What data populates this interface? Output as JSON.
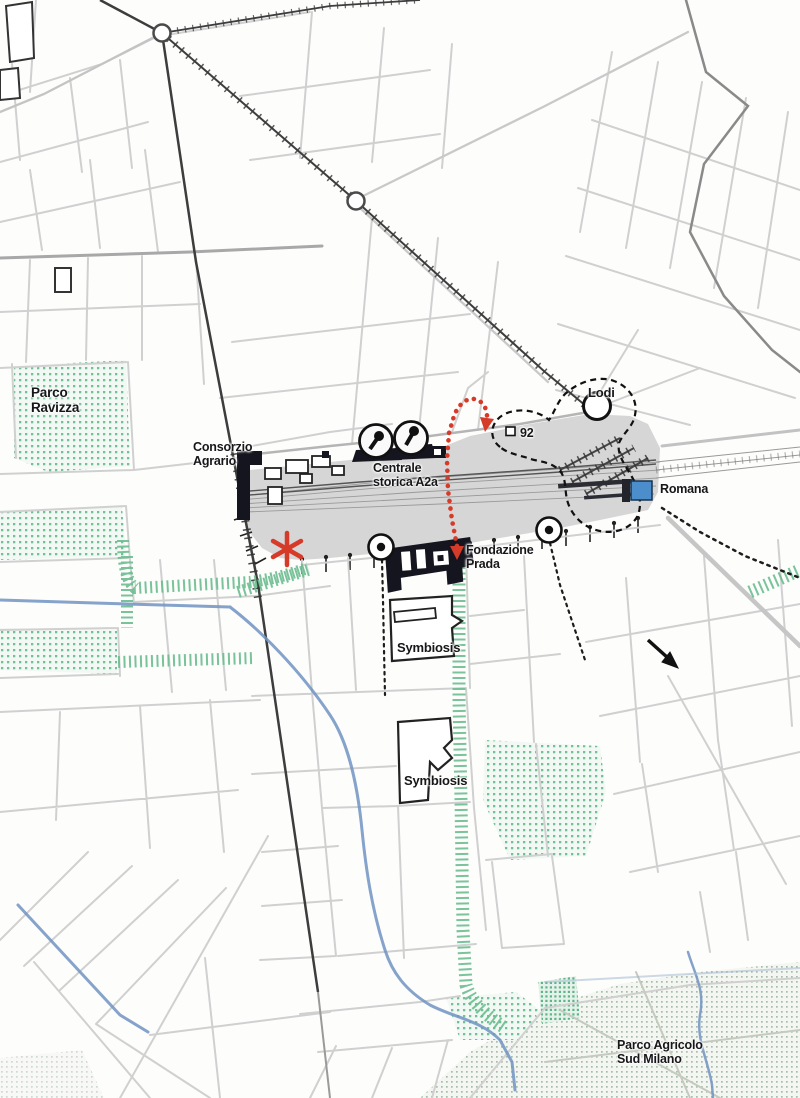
{
  "map": {
    "title": "Urban plan — Scalo di Porta Romana area, Milan",
    "labels": {
      "parco_ravizza": {
        "line1": "Parco",
        "line2": "Ravizza"
      },
      "consorzio": {
        "line1": "Consorzio",
        "line2": "Agrario"
      },
      "centrale_a2a": {
        "line1": "Centrale",
        "line2": "storica A2a"
      },
      "lodi": {
        "text": "Lodi"
      },
      "stop_92": {
        "text": "92"
      },
      "romana": {
        "text": "Romana"
      },
      "fondazione_prada": {
        "line1": "Fondazione",
        "line2": "Prada"
      },
      "symbiosis_north": {
        "text": "Symbiosis"
      },
      "symbiosis_south": {
        "text": "Symbiosis"
      },
      "parco_agricolo": {
        "line1": "Parco Agricolo",
        "line2": "Sud Milano"
      }
    },
    "colors": {
      "park_green": "#6fbd92",
      "route_red": "#d63a28",
      "water_blue": "#7093c2",
      "station_blue": "#4c8ecb",
      "rail_yard_gray": "#d6d6d6",
      "building_black": "#15151f",
      "street_gray": "#d0d0d0"
    }
  }
}
